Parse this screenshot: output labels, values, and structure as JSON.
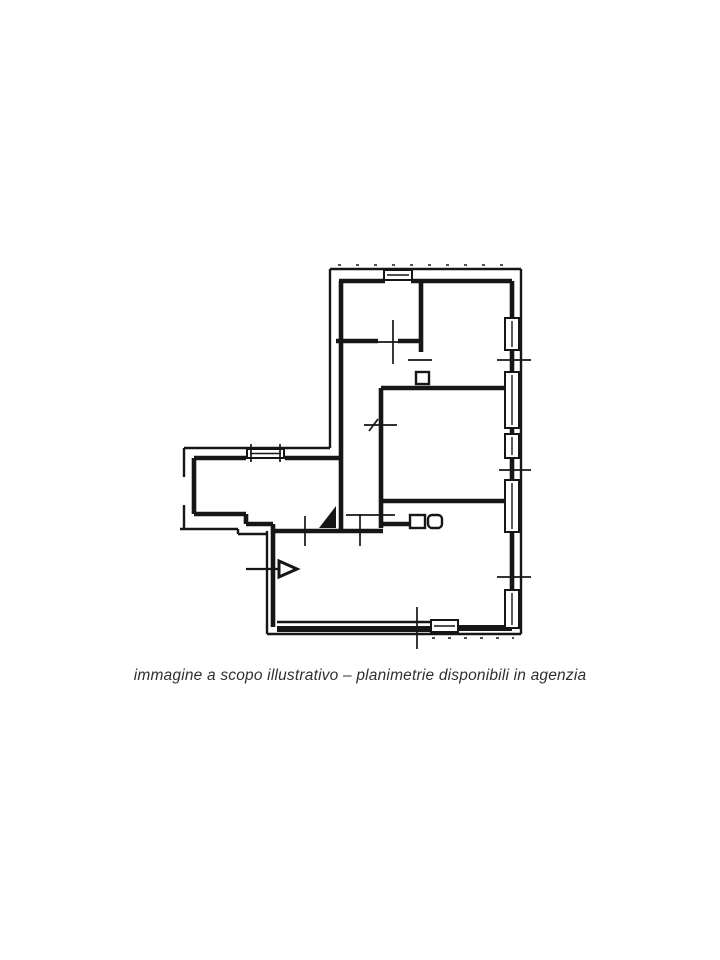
{
  "page": {
    "background": "#ffffff",
    "ink_color": "#161616",
    "caption_color": "#2f2f2f"
  },
  "caption": {
    "text": "immagine a scopo illustrativo – planimetrie disponibili in agenzia"
  },
  "floorplan": {
    "name": "apartment-floor-plan",
    "canvas": {
      "width": 720,
      "height": 960
    },
    "segments": {
      "outer_thin": [
        [
          330,
          269,
          521,
          269
        ],
        [
          521,
          269,
          521,
          634
        ],
        [
          521,
          634,
          267,
          634
        ],
        [
          267,
          634,
          267,
          531
        ],
        [
          180,
          529,
          238,
          529
        ],
        [
          238,
          529,
          238,
          534
        ],
        [
          238,
          534,
          267,
          534
        ],
        [
          184,
          529,
          184,
          505
        ],
        [
          184,
          477,
          184,
          448
        ],
        [
          184,
          448,
          330,
          448
        ],
        [
          330,
          448,
          330,
          269
        ],
        [
          277,
          622,
          430,
          622
        ]
      ],
      "inner_thick": [
        [
          339,
          281,
          385,
          281
        ],
        [
          411,
          281,
          512,
          281
        ],
        [
          512,
          281,
          512,
          318
        ],
        [
          512,
          350,
          512,
          372
        ],
        [
          512,
          428,
          512,
          434
        ],
        [
          512,
          458,
          512,
          480
        ],
        [
          512,
          532,
          512,
          590
        ],
        [
          341,
          281,
          341,
          531
        ],
        [
          194,
          458,
          194,
          514
        ],
        [
          194,
          458,
          246,
          458
        ],
        [
          285,
          458,
          341,
          458
        ],
        [
          194,
          514,
          246,
          514
        ],
        [
          246,
          514,
          246,
          524
        ],
        [
          246,
          524,
          273,
          524
        ],
        [
          273,
          627,
          273,
          524
        ],
        [
          273,
          531,
          383,
          531
        ],
        [
          336,
          341,
          378,
          341
        ],
        [
          398,
          341,
          421,
          341
        ],
        [
          421,
          283,
          421,
          352
        ],
        [
          381,
          388,
          512,
          388
        ],
        [
          381,
          388,
          381,
          528
        ],
        [
          383,
          501,
          505,
          501
        ],
        [
          383,
          524,
          412,
          524
        ]
      ],
      "heavy": [
        [
          277,
          629,
          430,
          629
        ],
        [
          459,
          628,
          512,
          628
        ]
      ],
      "ticks": [
        [
          393,
          320,
          393,
          364
        ],
        [
          377,
          342,
          409,
          342
        ],
        [
          408,
          360,
          432,
          360
        ],
        [
          497,
          360,
          531,
          360
        ],
        [
          499,
          470,
          531,
          470
        ],
        [
          497,
          577,
          531,
          577
        ],
        [
          364,
          425,
          397,
          425
        ],
        [
          369,
          431,
          378,
          419
        ],
        [
          346,
          515,
          395,
          515
        ],
        [
          305,
          516,
          305,
          546
        ],
        [
          360,
          514,
          360,
          546
        ],
        [
          417,
          607,
          417,
          649
        ],
        [
          251,
          444,
          251,
          462
        ],
        [
          280,
          444,
          280,
          462
        ]
      ],
      "dashed": [
        {
          "line": [
            338,
            265,
            516,
            265
          ],
          "dash": "3,15"
        },
        {
          "line": [
            432,
            638,
            514,
            638
          ],
          "dash": "3,13"
        }
      ]
    },
    "windows": [
      {
        "x": 505,
        "y": 318,
        "w": 14,
        "h": 32,
        "dir": "v"
      },
      {
        "x": 505,
        "y": 372,
        "w": 14,
        "h": 56,
        "dir": "v"
      },
      {
        "x": 505,
        "y": 434,
        "w": 14,
        "h": 24,
        "dir": "v"
      },
      {
        "x": 505,
        "y": 480,
        "w": 14,
        "h": 52,
        "dir": "v"
      },
      {
        "x": 505,
        "y": 590,
        "w": 14,
        "h": 38,
        "dir": "v"
      },
      {
        "x": 384,
        "y": 270,
        "w": 28,
        "h": 10,
        "dir": "h"
      },
      {
        "x": 247,
        "y": 449,
        "w": 37,
        "h": 9,
        "dir": "h"
      },
      {
        "x": 431,
        "y": 620,
        "w": 27,
        "h": 12,
        "dir": "h"
      }
    ],
    "jambs": [
      {
        "x": 416,
        "y": 372,
        "w": 13,
        "h": 12,
        "r": 0
      },
      {
        "x": 410,
        "y": 515,
        "w": 15,
        "h": 13,
        "r": 0
      },
      {
        "x": 428,
        "y": 515,
        "w": 14,
        "h": 13,
        "r": 4
      }
    ],
    "filled_triangles": [
      {
        "points": "336,506 336,528 319,528"
      }
    ],
    "entry_arrow": {
      "tail": [
        246,
        569,
        293,
        569
      ],
      "head": "279,561 297,569 279,577"
    }
  }
}
